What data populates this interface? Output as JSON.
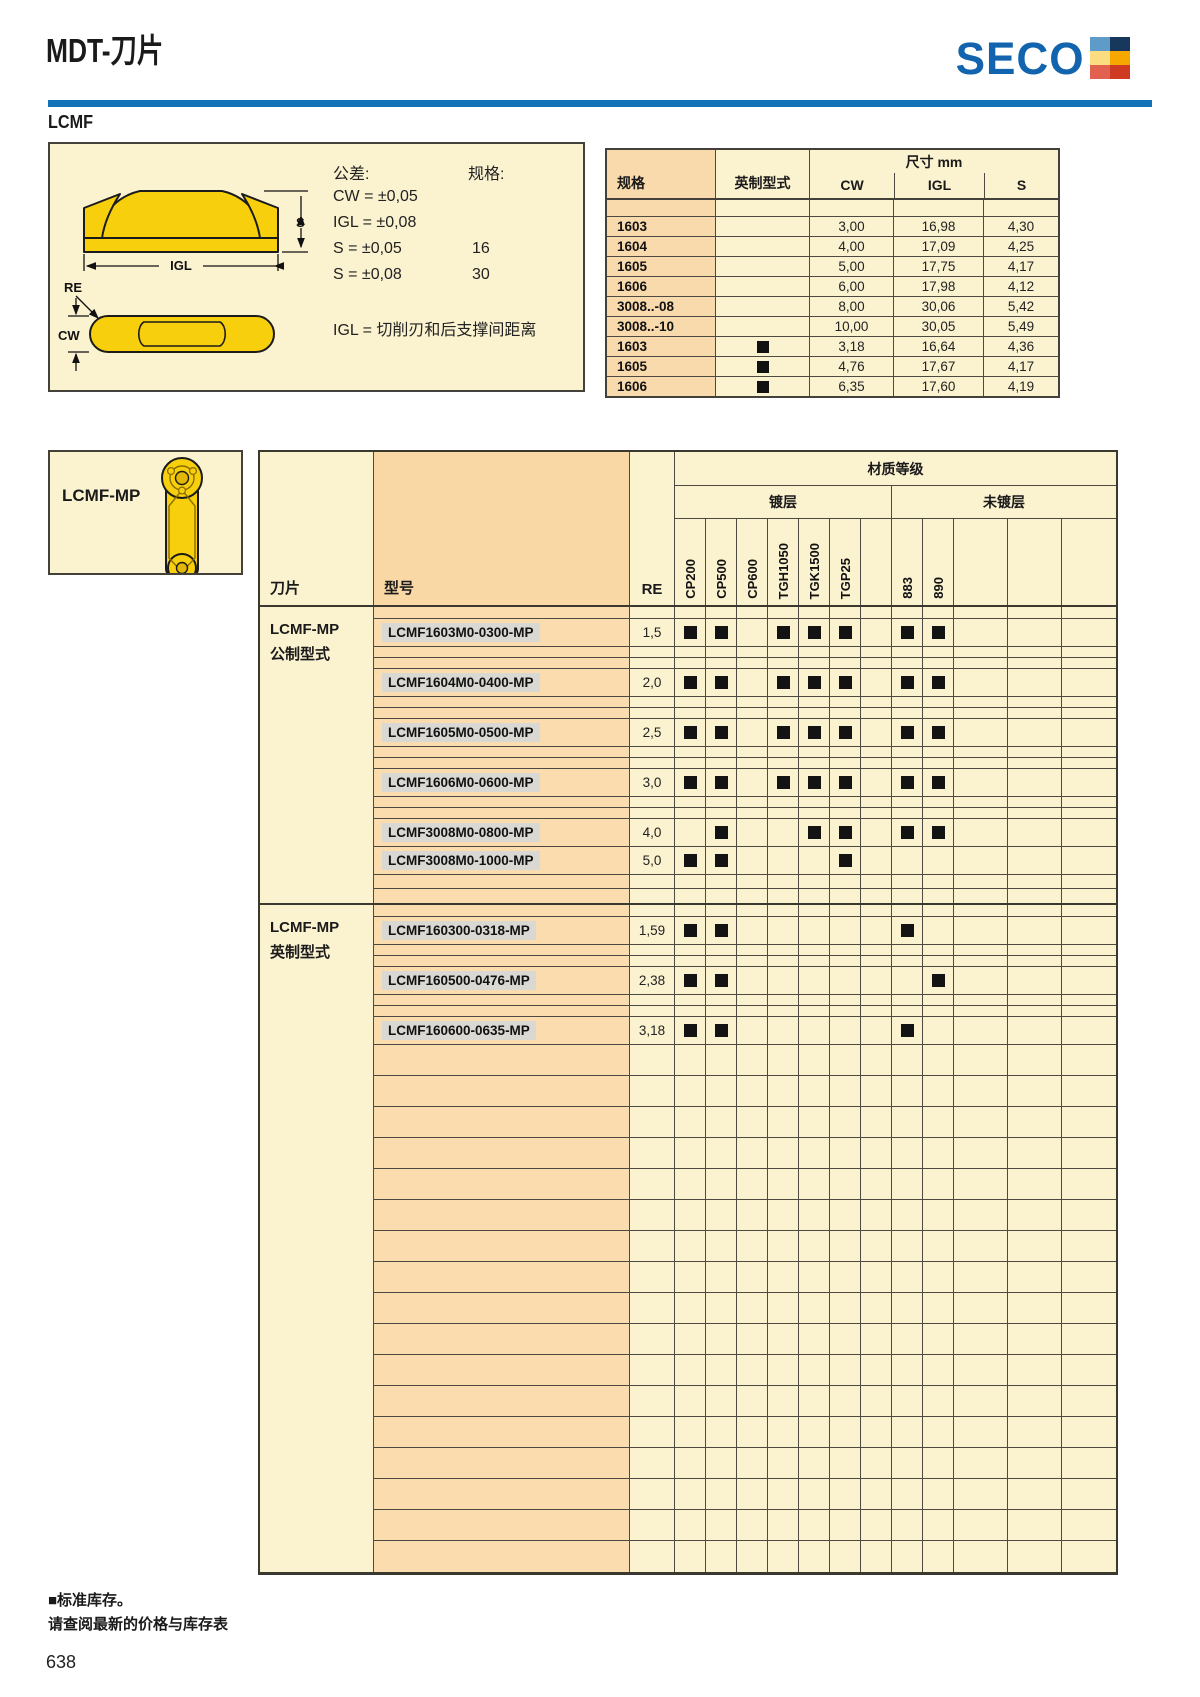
{
  "page": {
    "title": "MDT-刀片",
    "section": "LCMF",
    "page_number": "638",
    "footer_line1": "■标准库存。",
    "footer_line2": "请查阅最新的价格与库存表"
  },
  "logo": {
    "text": "SECO",
    "blue": "#1364AE",
    "squares": [
      "#5E9BC8",
      "#17375D",
      "#FCDC81",
      "#F6A800",
      "#E2604F",
      "#CE3B22"
    ]
  },
  "info_box": {
    "tolerance_label": "公差:",
    "tolerance_rows": [
      {
        "text": "CW = ±0,05",
        "size": ""
      },
      {
        "text": "IGL = ±0,08",
        "size": ""
      },
      {
        "text": "S = ±0,05",
        "size": "16"
      },
      {
        "text": "S = ±0,08",
        "size": "30"
      }
    ],
    "size_label": "规格:",
    "note": "IGL = 切削刃和后支撑间距离",
    "diagram": {
      "s": "S",
      "igl": "IGL",
      "re": "RE",
      "cw": "CW"
    }
  },
  "dim_table": {
    "group_header": "尺寸 mm",
    "col_spec": "规格",
    "col_inch": "英制型式",
    "col_cw": "CW",
    "col_igl": "IGL",
    "col_s": "S",
    "rows": [
      {
        "spec": "1603",
        "inch": false,
        "cw": "3,00",
        "igl": "16,98",
        "s": "4,30"
      },
      {
        "spec": "1604",
        "inch": false,
        "cw": "4,00",
        "igl": "17,09",
        "s": "4,25"
      },
      {
        "spec": "1605",
        "inch": false,
        "cw": "5,00",
        "igl": "17,75",
        "s": "4,17"
      },
      {
        "spec": "1606",
        "inch": false,
        "cw": "6,00",
        "igl": "17,98",
        "s": "4,12"
      },
      {
        "spec": "3008..-08",
        "inch": false,
        "cw": "8,00",
        "igl": "30,06",
        "s": "5,42"
      },
      {
        "spec": "3008..-10",
        "inch": false,
        "cw": "10,00",
        "igl": "30,05",
        "s": "5,49"
      },
      {
        "spec": "1603",
        "inch": true,
        "cw": "3,18",
        "igl": "16,64",
        "s": "4,36"
      },
      {
        "spec": "1605",
        "inch": true,
        "cw": "4,76",
        "igl": "17,67",
        "s": "4,17"
      },
      {
        "spec": "1606",
        "inch": true,
        "cw": "6,35",
        "igl": "17,60",
        "s": "4,19"
      }
    ]
  },
  "insert_box": {
    "label": "LCMF-MP"
  },
  "main_table": {
    "col_insert": "刀片",
    "col_model": "型号",
    "col_re": "RE",
    "grade_group": "材质等级",
    "coated_group": "镀层",
    "uncoated_group": "未镀层",
    "grade_columns": [
      "CP200",
      "CP500",
      "CP600",
      "TGH1050",
      "TGK1500",
      "TGP25",
      "",
      "883",
      "890",
      "",
      "",
      ""
    ],
    "sections": [
      {
        "label_line1": "LCMF-MP",
        "label_line2": "公制型式",
        "items": [
          {
            "model": "LCMF1603M0-0300-MP",
            "re": "1,5",
            "marks": [
              1,
              1,
              0,
              1,
              1,
              1,
              0,
              1,
              1,
              0,
              0,
              0
            ]
          },
          {
            "model": "LCMF1604M0-0400-MP",
            "re": "2,0",
            "marks": [
              1,
              1,
              0,
              1,
              1,
              1,
              0,
              1,
              1,
              0,
              0,
              0
            ]
          },
          {
            "model": "LCMF1605M0-0500-MP",
            "re": "2,5",
            "marks": [
              1,
              1,
              0,
              1,
              1,
              1,
              0,
              1,
              1,
              0,
              0,
              0
            ]
          },
          {
            "model": "LCMF1606M0-0600-MP",
            "re": "3,0",
            "marks": [
              1,
              1,
              0,
              1,
              1,
              1,
              0,
              1,
              1,
              0,
              0,
              0
            ]
          },
          {
            "model": "LCMF3008M0-0800-MP",
            "re": "4,0",
            "marks": [
              0,
              1,
              0,
              0,
              1,
              1,
              0,
              1,
              1,
              0,
              0,
              0
            ]
          },
          {
            "model": "LCMF3008M0-1000-MP",
            "re": "5,0",
            "marks": [
              1,
              1,
              0,
              0,
              0,
              1,
              0,
              0,
              0,
              0,
              0,
              0
            ]
          }
        ]
      },
      {
        "label_line1": "LCMF-MP",
        "label_line2": "英制型式",
        "items": [
          {
            "model": "LCMF160300-0318-MP",
            "re": "1,59",
            "marks": [
              1,
              1,
              0,
              0,
              0,
              0,
              0,
              1,
              0,
              0,
              0,
              0
            ]
          },
          {
            "model": "LCMF160500-0476-MP",
            "re": "2,38",
            "marks": [
              1,
              1,
              0,
              0,
              0,
              0,
              0,
              0,
              1,
              0,
              0,
              0
            ]
          },
          {
            "model": "LCMF160600-0635-MP",
            "re": "3,18",
            "marks": [
              1,
              1,
              0,
              0,
              0,
              0,
              0,
              1,
              0,
              0,
              0,
              0
            ]
          }
        ]
      }
    ],
    "empty_rows": 17,
    "stock_mark": "■"
  }
}
